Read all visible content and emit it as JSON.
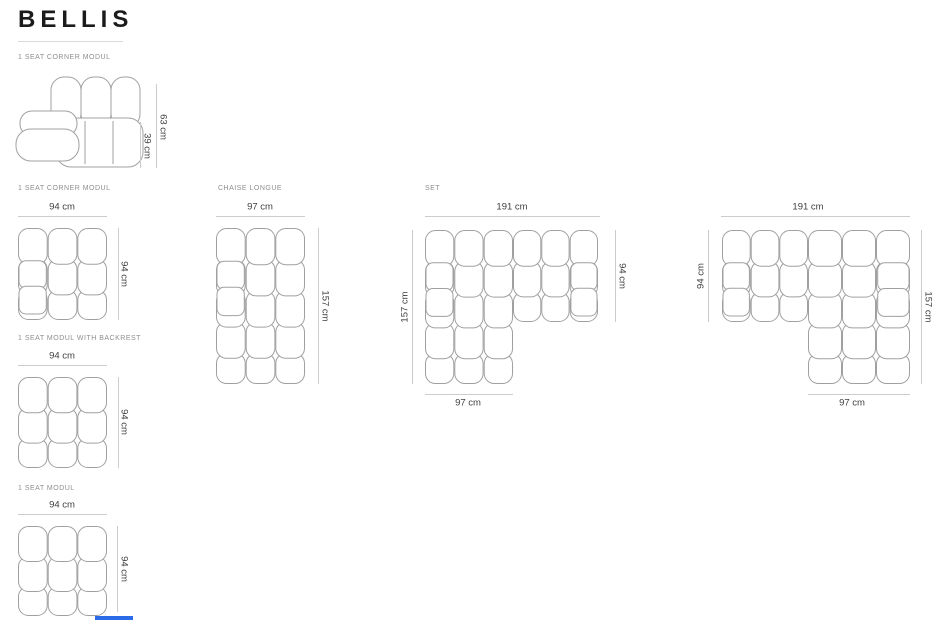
{
  "title": "BELLIS",
  "accent_bar_color": "#2c6be8",
  "figures": {
    "corner_side": {
      "label": "1 SEAT CORNER MODUL",
      "dim_total_height": "63 cm",
      "dim_seat_height": "39 cm"
    },
    "corner_top": {
      "label": "1 SEAT CORNER MODUL",
      "dim_width": "94 cm",
      "dim_depth": "94 cm"
    },
    "backrest_module": {
      "label": "1 SEAT MODUL WITH BACKREST",
      "dim_width": "94 cm",
      "dim_depth": "94 cm"
    },
    "seat_module": {
      "label": "1 SEAT MODUL",
      "dim_width": "94 cm",
      "dim_depth": "94 cm"
    },
    "chaise_longue": {
      "label": "CHAISE LONGUE",
      "dim_width": "97 cm",
      "dim_depth": "157 cm"
    },
    "set_left": {
      "label": "SET",
      "dim_total_width": "191 cm",
      "dim_left_depth": "157 cm",
      "dim_right_depth": "94 cm",
      "dim_chaise_width": "97 cm"
    },
    "set_right": {
      "dim_total_width": "191 cm",
      "dim_left_depth": "94 cm",
      "dim_right_depth": "157 cm",
      "dim_chaise_width": "97 cm"
    }
  }
}
